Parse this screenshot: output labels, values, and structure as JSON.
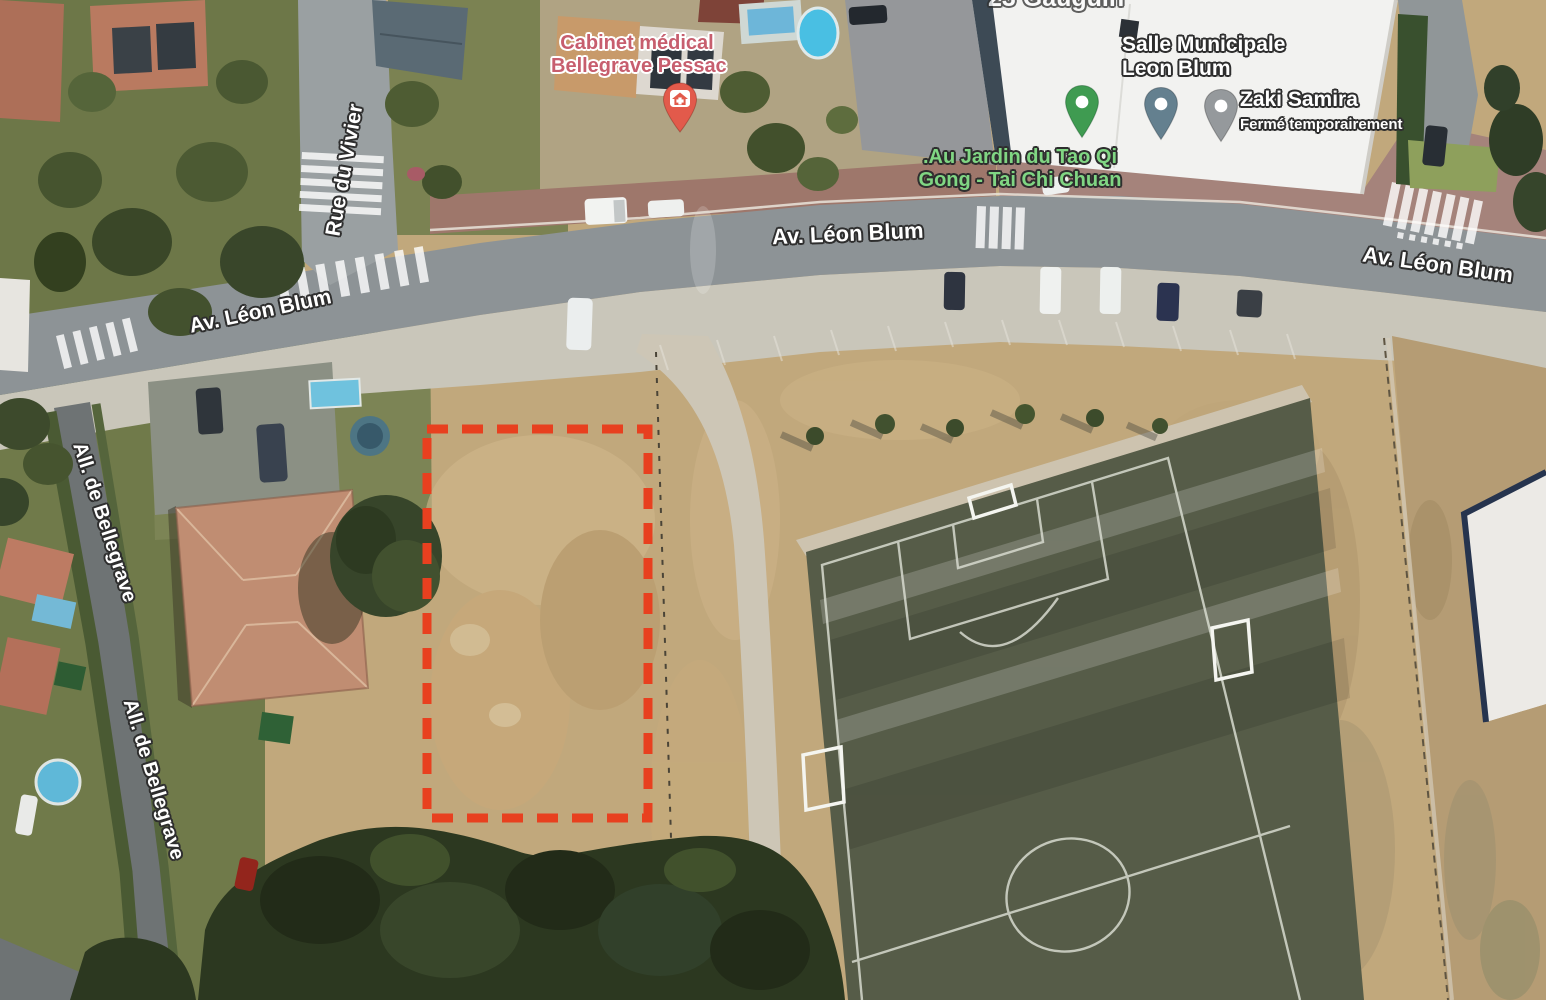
{
  "map": {
    "view_type": "satellite",
    "partial_label": {
      "text": "23 Gauguin"
    },
    "road_labels": {
      "av_left": "Av. Léon Blum",
      "av_center": "Av. Léon Blum",
      "av_right": "Av. Léon Blum",
      "rue_du_vivier": "Rue du Vivier",
      "allee_upper": "All. de Bellegrave",
      "allee_lower": "All. de Bellegrave"
    },
    "pois": {
      "medical": {
        "line1": "Cabinet médical",
        "line2": "Bellegrave Pessac"
      },
      "tai_chi": {
        "line1": ".Au Jardin du Tao Qi",
        "line2": "Gong - Tai Chi Chuan"
      },
      "salle": {
        "line1": "Salle Municipale",
        "line2": "Leon Blum"
      },
      "zaki": {
        "name": "Zaki Samira",
        "status": "Fermé temporairement"
      }
    }
  },
  "annotation": {
    "type": "dashed-rectangle",
    "color": "#e8401f"
  },
  "colors": {
    "medical_label": "#c75e6e",
    "medical_pin": "#e25a4b",
    "tai_chi_label": "#80d683",
    "green_pin": "#3f9b51",
    "slate_pin": "#64808f",
    "gray_pin": "#95999c",
    "pitch_green": "#565c48",
    "road_gray": "#8d9396",
    "dirt_tan": "#c1a87c"
  }
}
